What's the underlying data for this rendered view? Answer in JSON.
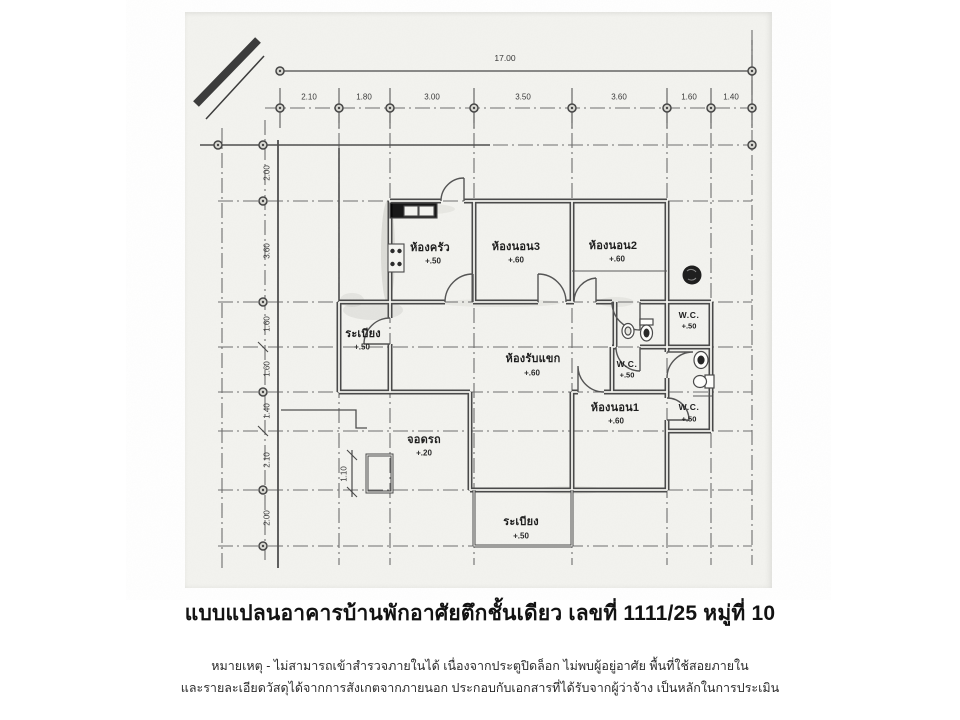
{
  "title": "แบบแปลนอาคารบ้านพักอาศัยตึกชั้นเดียว เลขที่ 1111/25 หมู่ที่ 10",
  "notes": {
    "line1": "หมายเหตุ - ไม่สามารถเข้าสำรวจภายในได้ เนื่องจากประตูปิดล็อก ไม่พบผู้อยู่อาศัย พื้นที่ใช้สอยภายใน",
    "line2": "และรายละเอียดวัสดุได้จากการสังเกตจากภายนอก ประกอบกับเอกสารที่ได้รับจากผู้ว่าจ้าง เป็นหลักในการประเมิน"
  },
  "dimensions": {
    "total_width": "17.00",
    "top_row": [
      "2.10",
      "1.80",
      "3.00",
      "3.50",
      "3.60",
      "1.60",
      "1.40"
    ],
    "left_col": [
      "2.00",
      "3.60",
      "1.60",
      "1.60",
      "1.40",
      "2.10",
      "2.00"
    ],
    "step": "1.10"
  },
  "rooms": {
    "kitchen": {
      "name": "ห้องครัว",
      "level": "+.50"
    },
    "bedroom3": {
      "name": "ห้องนอน3",
      "level": "+.60"
    },
    "bedroom2": {
      "name": "ห้องนอน2",
      "level": "+.60"
    },
    "balcony_left": {
      "name": "ระเบียง",
      "level": "+.50"
    },
    "living": {
      "name": "ห้องรับแขก",
      "level": "+.60"
    },
    "wc_top": {
      "name": "W.C.",
      "level": "+.50"
    },
    "wc_mid": {
      "name": "W.C.",
      "level": "+.50"
    },
    "bedroom1": {
      "name": "ห้องนอน1",
      "level": "+.60"
    },
    "wc_bottom": {
      "name": "W.C.",
      "level": "+.50"
    },
    "parking": {
      "name": "จอดรถ",
      "level": "+.20"
    },
    "balcony_bottom": {
      "name": "ระเบียง",
      "level": "+.50"
    }
  },
  "colors": {
    "line": "#474747",
    "scan_bg": "#f3f3ef",
    "page_bg": "#ffffff"
  }
}
